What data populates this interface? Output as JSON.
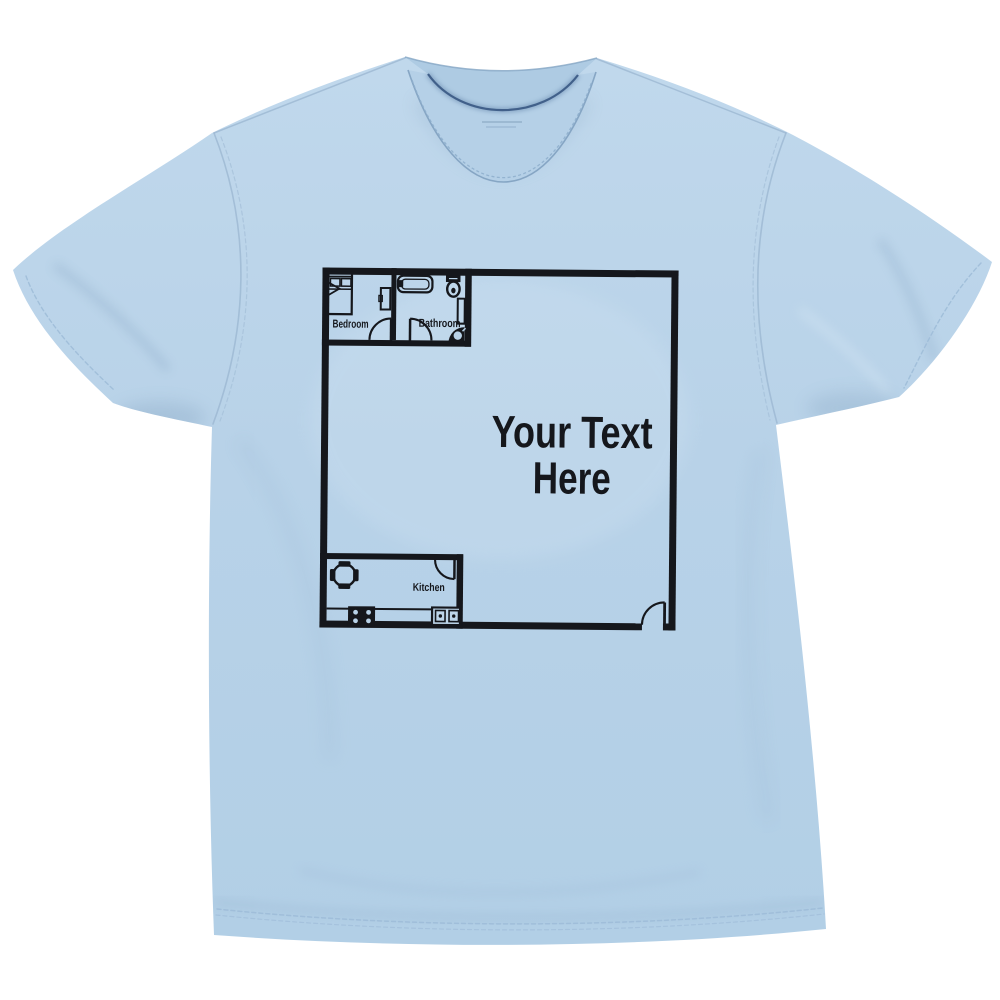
{
  "scene": {
    "description": "Product photo of a light blue crew-neck t-shirt lying flat on a white background, printed with a black one-bedroom apartment floor plan and customizable text area",
    "background_color": "#ffffff",
    "shirt_color": "#b8d2e8",
    "print_ink_color": "#15171c"
  },
  "print": {
    "text_line1": "Your Text",
    "text_line2": "Here",
    "labels": {
      "bedroom": "Bedroom",
      "bathroom": "Bathroom",
      "kitchen": "Kitchen"
    },
    "icons": [
      "bed-icon",
      "dresser-icon",
      "bathtub-icon",
      "toilet-icon",
      "vanity-icon",
      "corner-sink-icon",
      "dining-table-icon",
      "chair-icon",
      "counter-icon",
      "stove-icon",
      "kitchen-sink-icon",
      "door-swing-icon"
    ],
    "door_count": 4
  }
}
